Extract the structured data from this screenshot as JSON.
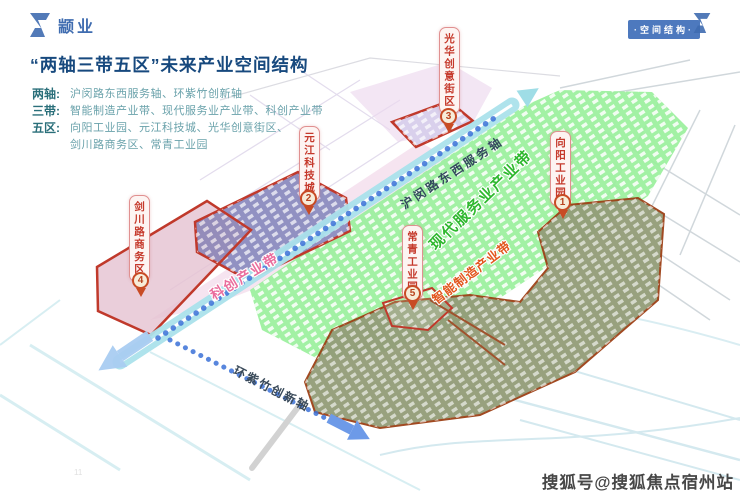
{
  "brand": {
    "logo_text": "颛业"
  },
  "header": {
    "corner_badge": "·空间结构·"
  },
  "title": "“两轴三带五区”未来产业空间结构",
  "legend": {
    "rows": [
      {
        "key": "两轴:",
        "value": "沪闵路东西服务轴、环紫竹创新轴"
      },
      {
        "key": "三带:",
        "value": "智能制造产业带、现代服务业产业带、科创产业带"
      },
      {
        "key": "五区:",
        "value": "向阳工业园、元江科技城、光华创意街区、",
        "value2": "剑川路商务区、常青工业园"
      }
    ]
  },
  "map": {
    "axes": [
      {
        "name": "沪闵路东西服务轴"
      },
      {
        "name": "环紫竹创新轴"
      }
    ],
    "belts": [
      {
        "name": "智能制造产业带",
        "color": "#e2571e"
      },
      {
        "name": "现代服务业产业带",
        "color": "#2eb82e"
      },
      {
        "name": "科创产业带",
        "color": "#ea6d9d"
      }
    ],
    "districts": [
      {
        "num": "1",
        "name": "向阳工业园"
      },
      {
        "num": "2",
        "name": "元江科技城"
      },
      {
        "num": "3",
        "name": "光华创意街区"
      },
      {
        "num": "4",
        "name": "剑川路商务区"
      },
      {
        "num": "5",
        "name": "常青工业园"
      }
    ],
    "zone_colors": {
      "road_band": "#abe2ec",
      "axis_dotted": "#3b72d8",
      "green_zone": "#98ef9a",
      "olive_zone": "#939c78",
      "purple_zone": "#9191c2",
      "pink_zone": "#f2d9e9",
      "district_outline": "#c0392b"
    }
  },
  "footer": {
    "watermark": "搜狐号@搜狐焦点宿州站",
    "page_number": "11"
  }
}
